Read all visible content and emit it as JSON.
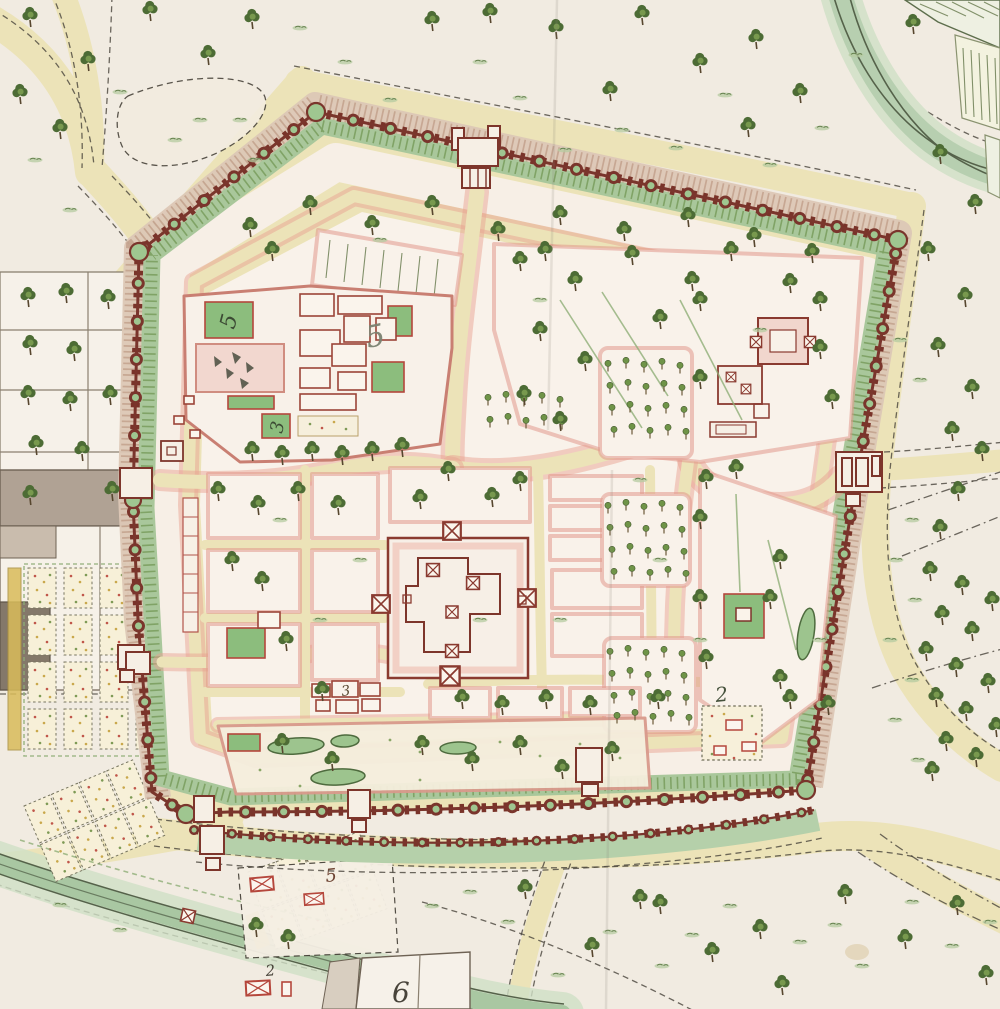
{
  "map": {
    "kind": "hand-drawn watercolor fortified city plan",
    "visible_numeral_labels": [
      "5",
      "5",
      "3",
      "3",
      "2",
      "6",
      "5",
      "2",
      "6"
    ]
  },
  "labels": {
    "nw_court_five": {
      "text": "5",
      "location": "northwest palace courtyard"
    },
    "nw_garden_five": {
      "text": "5",
      "location": "northwest palace garden"
    },
    "nw_court_three": {
      "text": "3",
      "location": "northwest palace south courtyard"
    },
    "south_cluster_three": {
      "text": "3",
      "location": "building cluster south of central compound"
    },
    "se_garden_two": {
      "text": "2",
      "location": "southeast walled flower garden"
    },
    "west_six": {
      "text": "6",
      "location": "west suburb plot"
    },
    "outside_south_five": {
      "text": "5",
      "location": "hamlet south of fort"
    },
    "outside_south_two": {
      "text": "2",
      "location": "riverside hamlet southwest"
    },
    "bottom_six": {
      "text": "6",
      "location": "plot at bottom edge"
    }
  },
  "palette": {
    "paper": "#f1ebe1",
    "road_cream": "#ece3b8",
    "wall_maroon": "#7a352c",
    "rampart_green": "#a9c79b",
    "glacis_tan": "#dcc7b5",
    "river_green": "#b7cfb0",
    "block_fill": "#f9f2ea",
    "block_edge_pink": "#e2998c",
    "courtyard_green": "#8cbd7d",
    "tree_green": "#4d6c35",
    "water_edge": "#55624a",
    "gray_building": "#84786a",
    "flower_red": "#c0564a",
    "flower_yellow": "#c9a84c",
    "label_ink_olive": "#3c4a34",
    "label_ink_dark": "#48433a"
  },
  "icons": {
    "tree": "deciduous-tree-icon",
    "orchard_tree": "orchard-tree-icon",
    "grass": "grass-tuft-icon",
    "gate_marker": "crossed-gate-icon",
    "building_x": "crossed-building-icon",
    "flower_bed": "flower-bed-icon"
  }
}
